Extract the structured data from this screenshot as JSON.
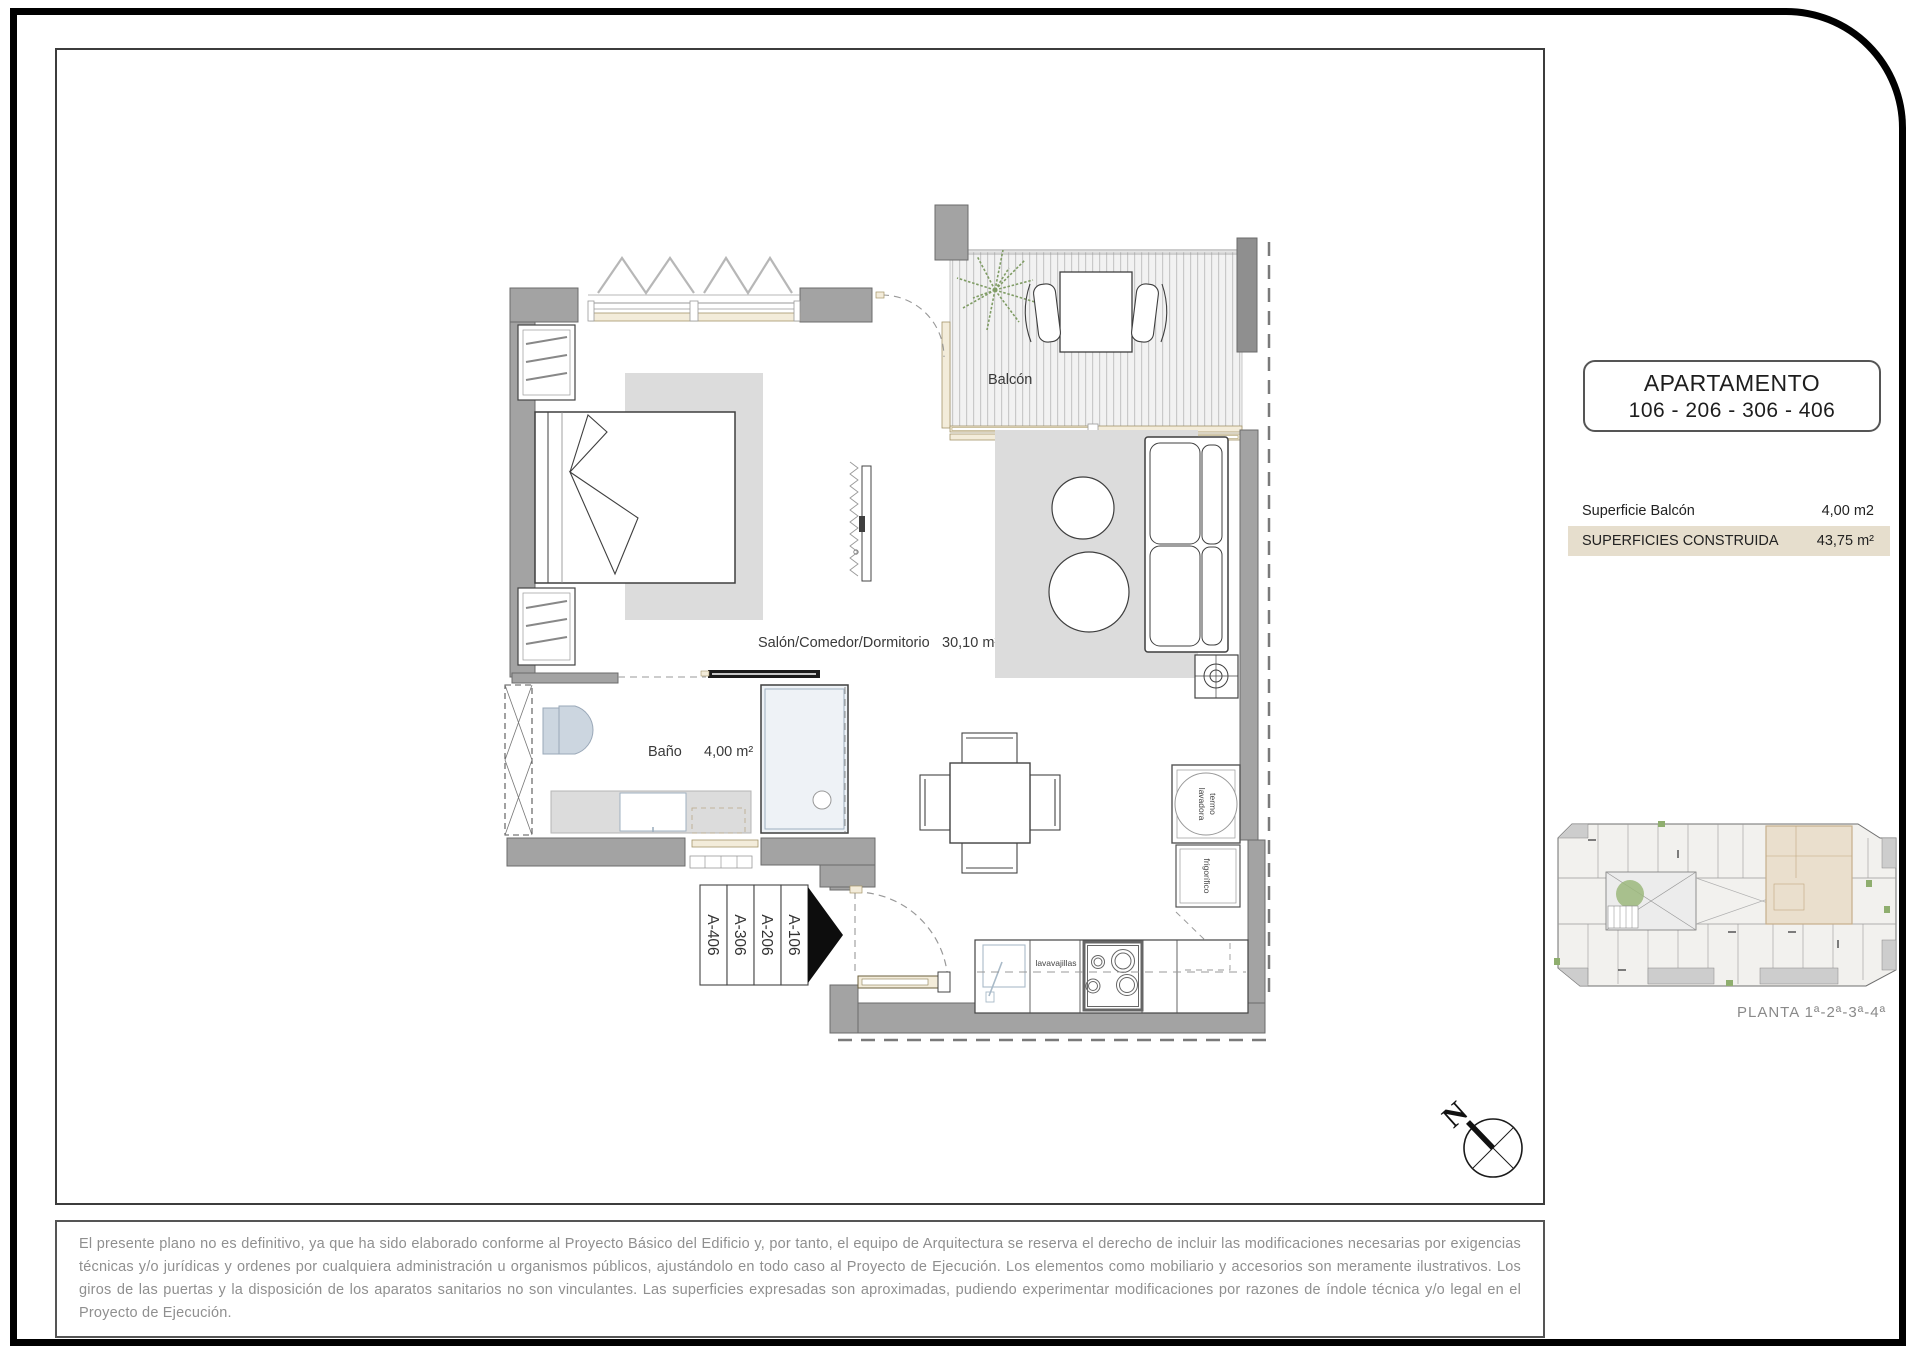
{
  "header": {
    "title": "APARTAMENTO",
    "units": "106 - 206 - 306 - 406"
  },
  "surfaces": {
    "balcony_label": "Superficie Balcón",
    "balcony_value": "4,00 m2",
    "built_label": "SUPERFICIES CONSTRUIDA",
    "built_value": "43,75 m²"
  },
  "plan": {
    "balcony_label": "Balcón",
    "living_label": "Salón/Comedor/Dormitorio",
    "living_area": "30,10 m²",
    "bath_label": "Baño",
    "bath_area": "4,00 m²",
    "unit_tags": [
      "A-406",
      "A-306",
      "A-206",
      "A-106"
    ],
    "appliances": {
      "termo_line1": "termo",
      "termo_line2": "lavadora",
      "fridge": "frigorífico",
      "dishwasher": "lavavajillas"
    }
  },
  "keyplan": {
    "caption": "PLANTA 1ª-2ª-3ª-4ª"
  },
  "compass": {
    "north": "N"
  },
  "disclaimer": {
    "text": "El presente plano no es definitivo, ya que ha sido elaborado conforme al Proyecto Básico del Edificio y, por tanto, el equipo de Arquitectura se reserva el derecho de incluir las modificaciones necesarias por exigencias técnicas y/o jurídicas y ordenes por cualquiera administración u organismos públicos, ajustándolo en todo caso al Proyecto de Ejecución. Los elementos como mobiliario y accesorios son meramente ilustrativos. Los giros de las puertas y la disposición de los aparatos sanitarios no son vinculantes. Las superficies expresadas son aproximadas, pudiendo experimentar modificaciones por razones de índole técnica y/o legal en el Proyecto de Ejecución."
  },
  "colors": {
    "highlight_row": "#e6decd",
    "keyplan_highlight": "#eadfcd",
    "wall_gray": "#a3a3a3",
    "greenery": "#8fae6e"
  }
}
